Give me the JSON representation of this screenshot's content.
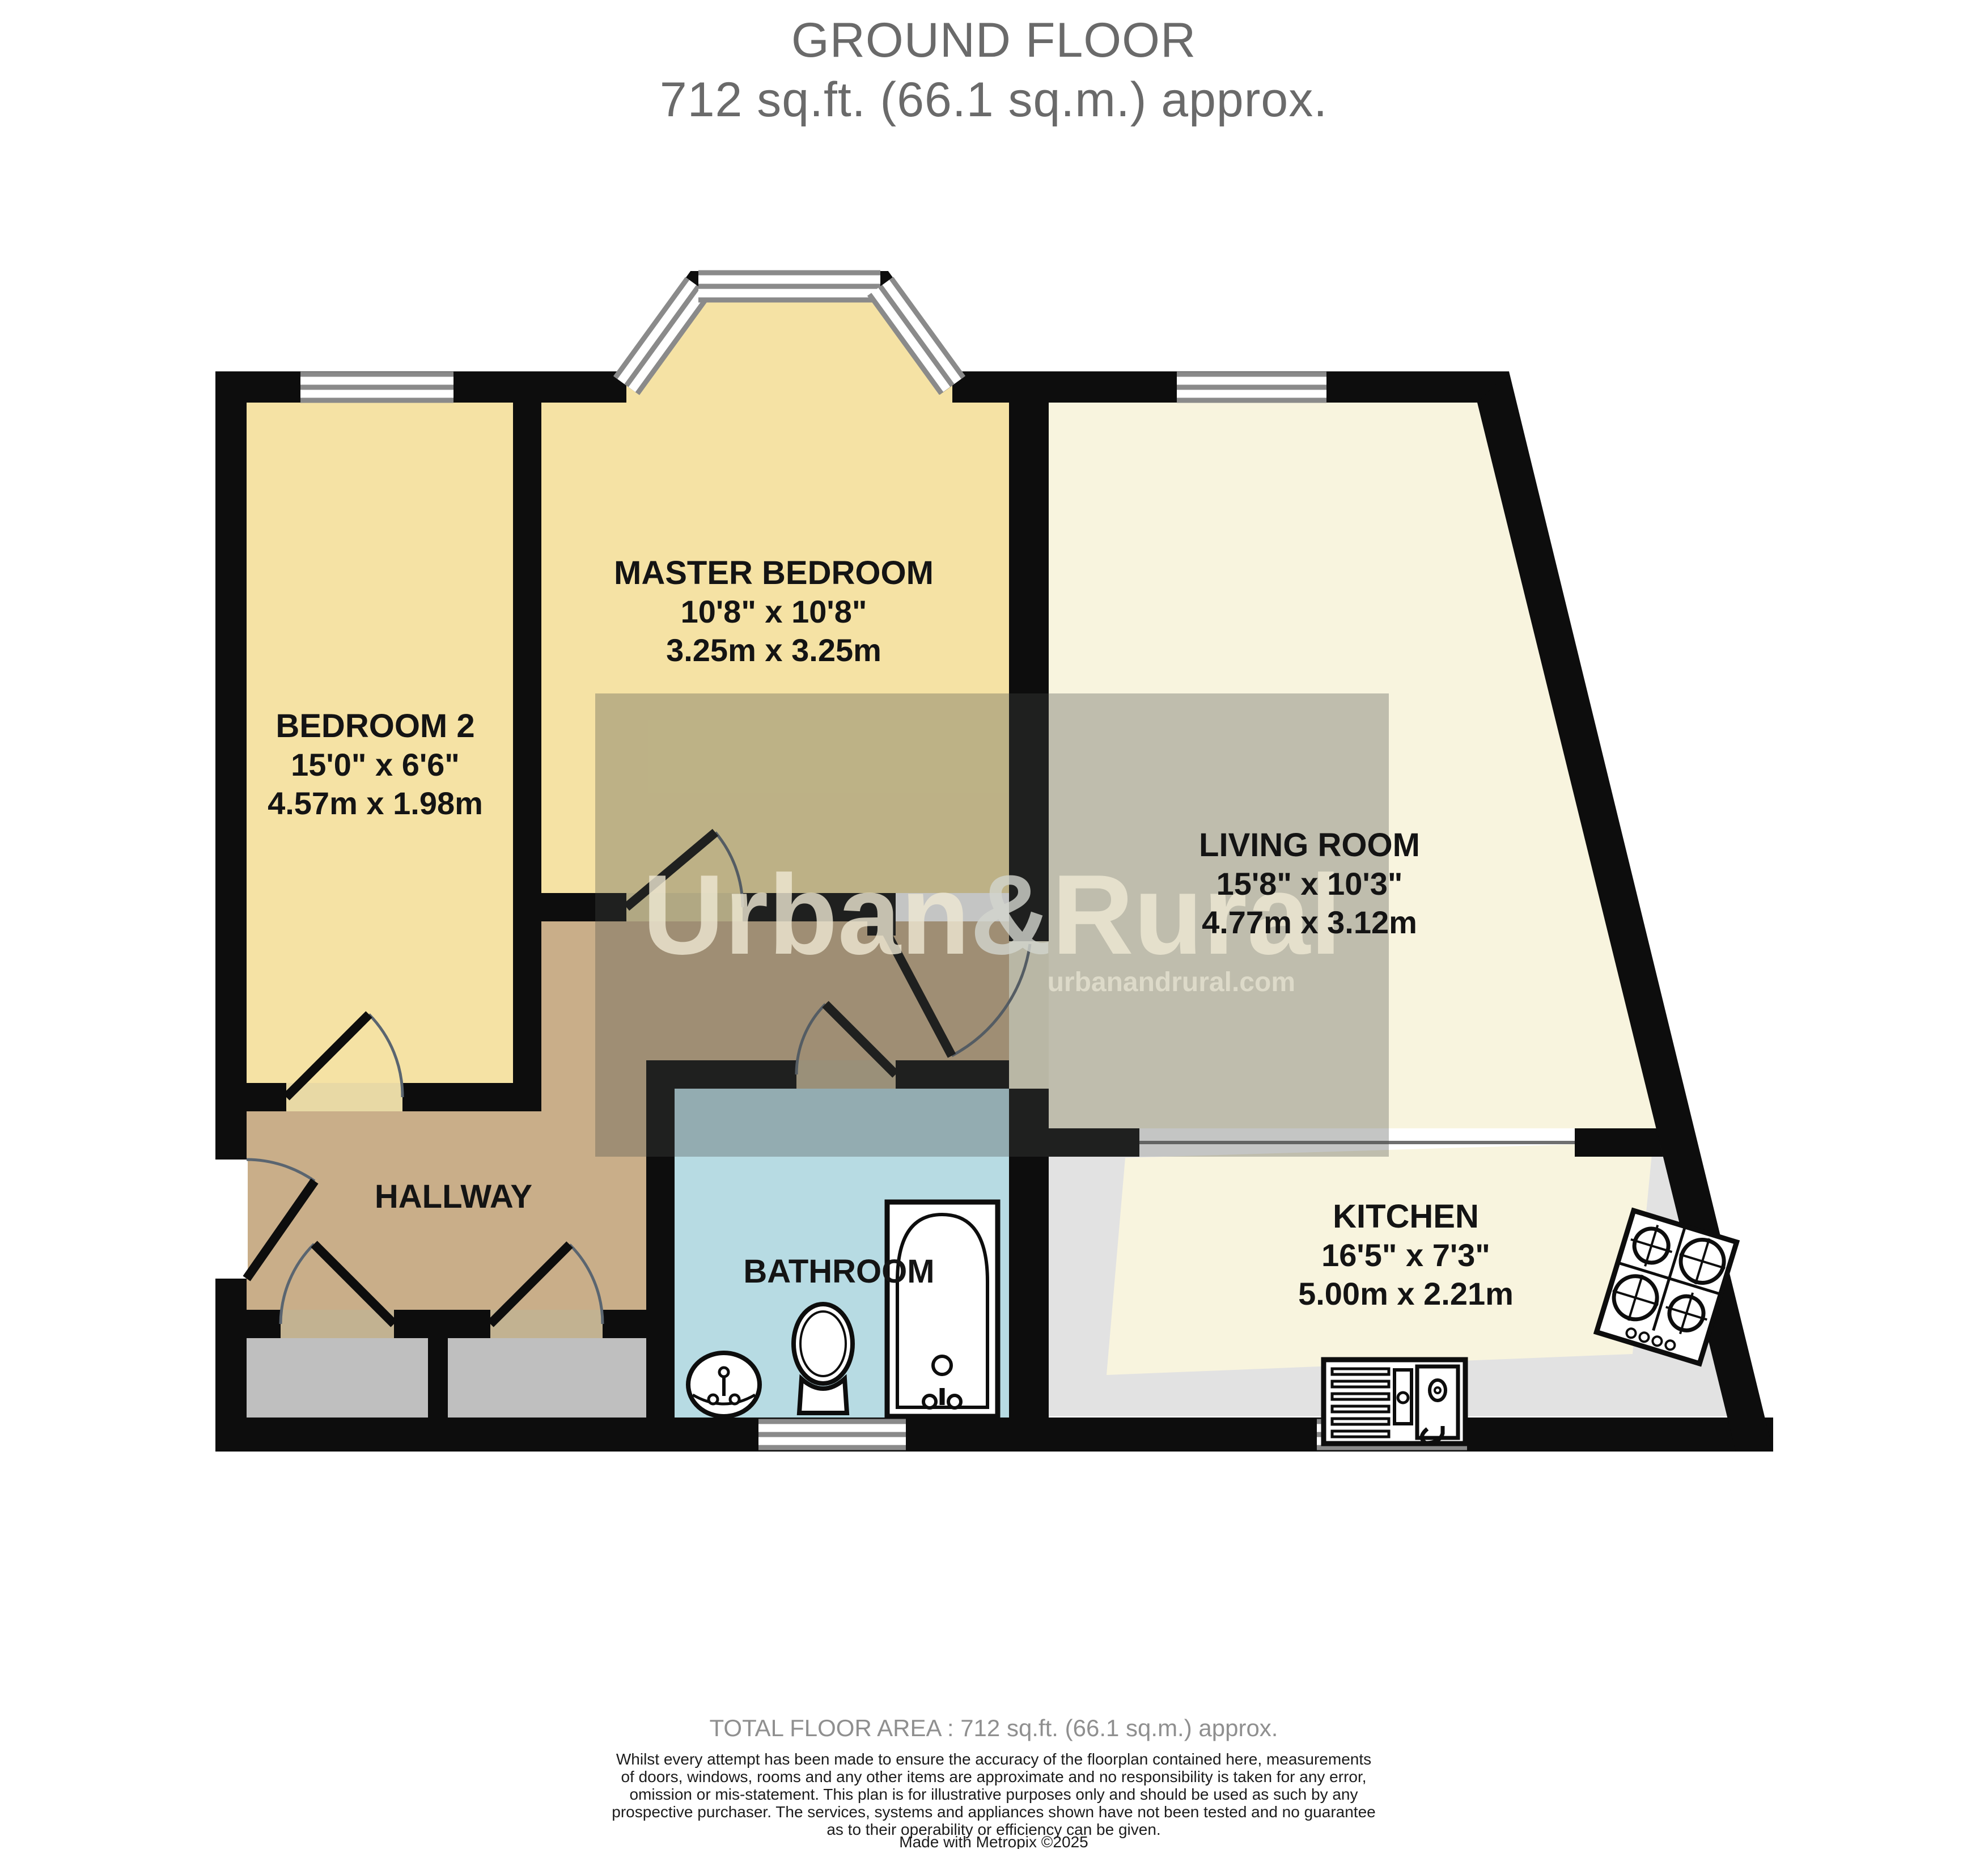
{
  "title": {
    "line1": "GROUND FLOOR",
    "line2": "712 sq.ft. (66.1 sq.m.) approx."
  },
  "rooms": [
    {
      "id": "master-bedroom",
      "name": "MASTER BEDROOM",
      "imperial": "10'8\" x 10'8\"",
      "metric": "3.25m x 3.25m"
    },
    {
      "id": "bedroom-2",
      "name": "BEDROOM 2",
      "imperial": "15'0\" x 6'6\"",
      "metric": "4.57m x 1.98m"
    },
    {
      "id": "living-room",
      "name": "LIVING ROOM",
      "imperial": "15'8\" x 10'3\"",
      "metric": "4.77m x 3.12m"
    },
    {
      "id": "kitchen",
      "name": "KITCHEN",
      "imperial": "16'5\" x 7'3\"",
      "metric": "5.00m x 2.21m"
    },
    {
      "id": "hallway",
      "name": "HALLWAY"
    },
    {
      "id": "bathroom",
      "name": "BATHROOM"
    }
  ],
  "watermark": {
    "brand_left": "Urban",
    "amp": "&",
    "brand_right": "Rural",
    "website": "urbanandrural.com"
  },
  "footer": {
    "total_area": "TOTAL FLOOR AREA : 712 sq.ft. (66.1 sq.m.) approx.",
    "disclaimer_lines": [
      "Whilst every attempt has been made to ensure the accuracy of the floorplan contained here, measurements",
      "of doors, windows, rooms and any other items are approximate and no responsibility is taken for any error,",
      "omission or mis-statement. This plan is for illustrative purposes only and should be used as such by any",
      "prospective purchaser. The services, systems and appliances shown have not been tested and no guarantee",
      "as to their operability or efficiency can be given."
    ],
    "credit": "Made with Metropix ©2025"
  },
  "colors": {
    "wall": "#0d0d0d",
    "bedroom_fill": "#F5E2A4",
    "living_fill": "#F8F4DE",
    "kitchen_gray": "#E2E2E2",
    "closet_gray": "#BFBFBF",
    "hallway_tan": "#C9AE89",
    "bathroom_blue": "#B7DBE3",
    "window_line": "#8a8a8a",
    "title_gray": "#6a6a6a"
  }
}
